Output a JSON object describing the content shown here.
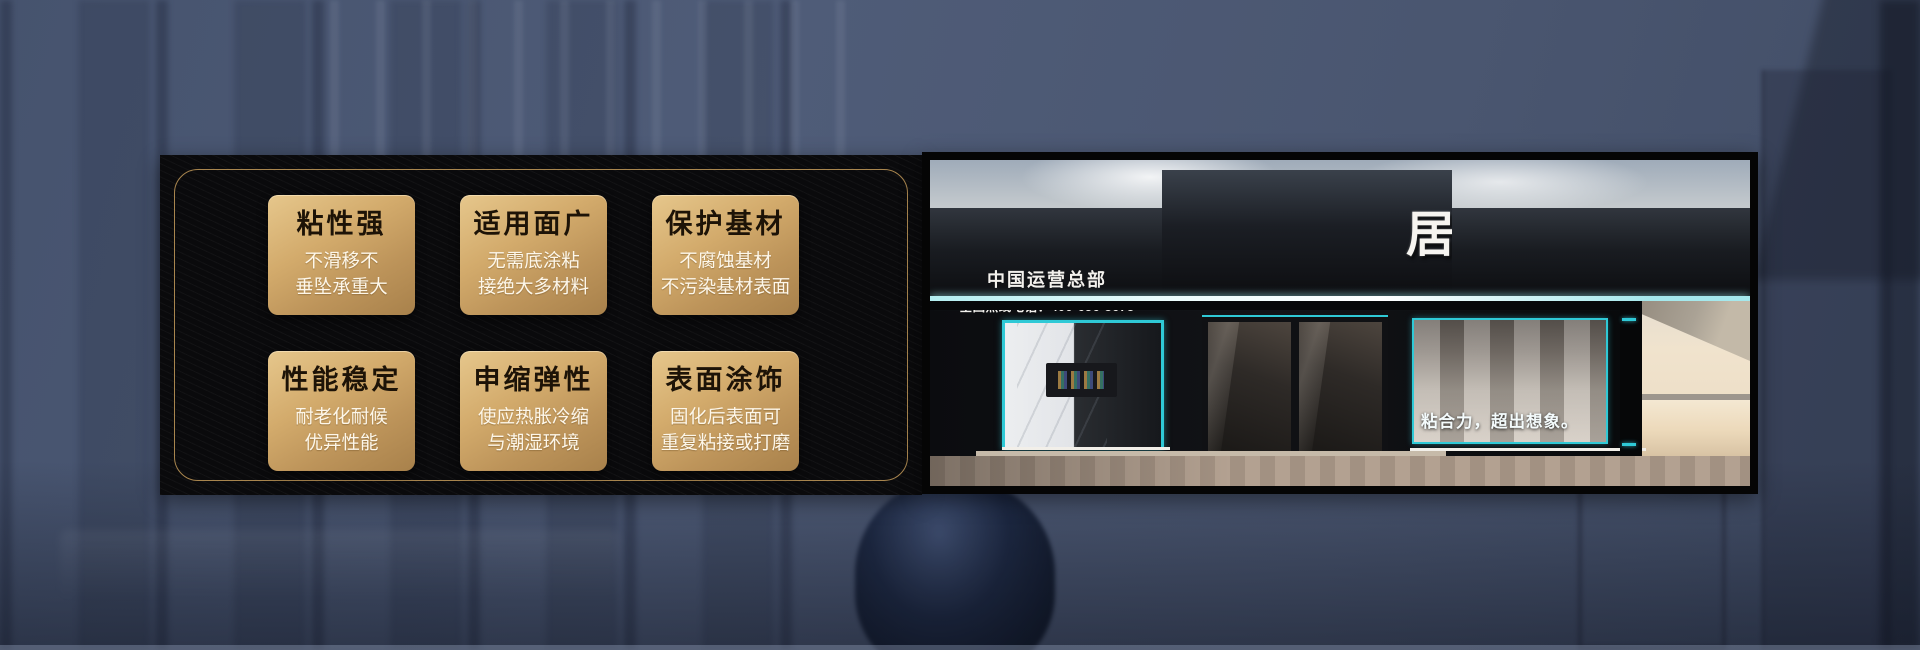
{
  "colors": {
    "background_blue": "#4b5874",
    "panel_black": "#0a0a0c",
    "gold_border": "#a8854e",
    "card_gold_top": "#e6c78c",
    "card_gold_bottom": "#a8814b",
    "card_title_text": "#1d1307",
    "card_desc_text": "#fdf7ea",
    "teal_accent": "#2fc9d6",
    "sign_text": "#f6f4f0"
  },
  "features_panel": {
    "cards": [
      {
        "title": "粘性强",
        "line1": "不滑移不",
        "line2": "垂坠承重大"
      },
      {
        "title": "适用面广",
        "line1": "无需底涂粘",
        "line2": "接绝大多材料"
      },
      {
        "title": "保护基材",
        "line1": "不腐蚀基材",
        "line2": "不污染基材表面"
      },
      {
        "title": "性能稳定",
        "line1": "耐老化耐候",
        "line2": "优异性能"
      },
      {
        "title": "申缩弹性",
        "line1": "使应热胀冷缩",
        "line2": "与潮湿环境"
      },
      {
        "title": "表面涂饰",
        "line1": "固化后表面可",
        "line2": "重复粘接或打磨"
      }
    ]
  },
  "storefront": {
    "hq_label": "中国运营总部",
    "hotline": "全国热线电话：400-656-8678",
    "brand_name": "居美匠",
    "product_name": "钢钉胶",
    "product_tagline": "新一代技术",
    "right_slogan": "|开启环保之美|",
    "window_slogan": "粘合力，超出想象。"
  }
}
